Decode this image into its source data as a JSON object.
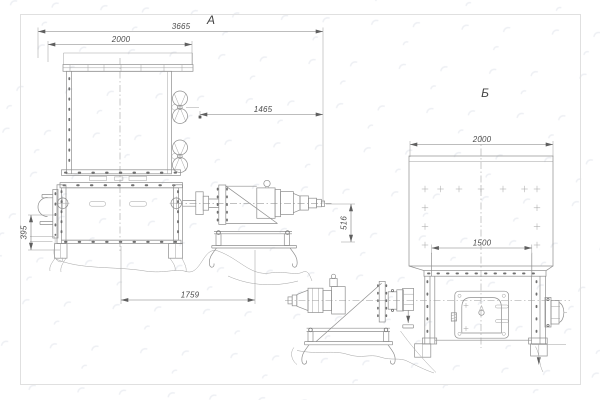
{
  "document": {
    "type": "technical-drawing",
    "background": "#ffffff"
  },
  "views": {
    "a": {
      "label": "А",
      "dimensions": {
        "overall": "3665",
        "hopper": "2000",
        "drive": "1465",
        "left_height": "395",
        "right_height": "516",
        "base": "1759"
      }
    },
    "b": {
      "label": "Б",
      "dimensions": {
        "hopper": "2000",
        "outlet": "1500"
      }
    }
  },
  "colors": {
    "background": "#ffffff",
    "frame": "#e0e0e0",
    "line": "#8e8e8e",
    "line_dark": "#6d6d6d",
    "dim_text": "#4c4c4c",
    "watermark": "#eef0f4"
  }
}
